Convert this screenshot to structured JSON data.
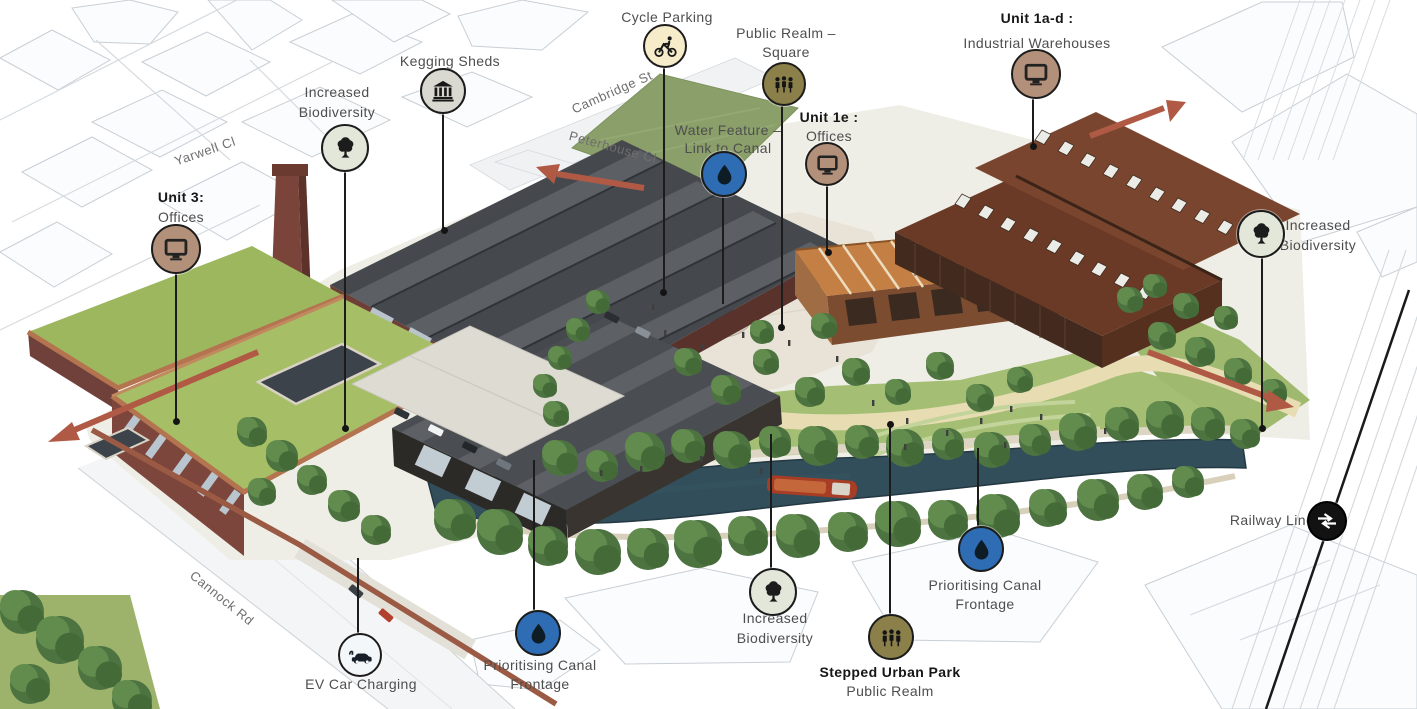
{
  "figure": {
    "kind": "annotated-masterplan-aerial-render"
  },
  "streets": [
    {
      "name": "Yarwell Cl"
    },
    {
      "name": "Cambridge St"
    },
    {
      "name": "Peterhouse Cl"
    },
    {
      "name": "Cannock Rd"
    }
  ],
  "callouts": [
    {
      "id": "unit-3",
      "lines": [
        "Unit 3:",
        "Offices"
      ],
      "icon": "computer-monitor"
    },
    {
      "id": "increased-biodiversity-top-left",
      "lines": [
        "Increased",
        "Biodiversity"
      ],
      "icon": "tree"
    },
    {
      "id": "kegging-sheds",
      "lines": [
        "Kegging Sheds"
      ],
      "icon": "heritage-building"
    },
    {
      "id": "cycle-parking",
      "lines": [
        "Cycle Parking"
      ],
      "icon": "bicycle"
    },
    {
      "id": "public-realm-square",
      "lines": [
        "Public Realm –",
        "Square"
      ],
      "icon": "people"
    },
    {
      "id": "water-feature",
      "lines": [
        "Water Feature –",
        "Link to Canal"
      ],
      "icon": "water-drop"
    },
    {
      "id": "unit-1e",
      "lines": [
        "Unit 1e :",
        "Offices"
      ],
      "icon": "computer-monitor"
    },
    {
      "id": "unit-1a-d",
      "lines": [
        "Unit 1a-d :",
        "Industrial Warehouses"
      ],
      "icon": "computer-monitor"
    },
    {
      "id": "increased-biodiversity-right",
      "lines": [
        "Increased",
        "Biodiversity"
      ],
      "icon": "tree"
    },
    {
      "id": "railway-line",
      "lines": [
        "Railway Line"
      ],
      "icon": "national-rail"
    },
    {
      "id": "prioritising-canal-frontage-right",
      "lines": [
        "Prioritising Canal",
        "Frontage"
      ],
      "icon": "water-drop"
    },
    {
      "id": "stepped-urban-park",
      "lines": [
        "Stepped Urban Park",
        "Public Realm"
      ],
      "icon": "people"
    },
    {
      "id": "increased-biodiversity-bottom",
      "lines": [
        "Increased",
        "Biodiversity"
      ],
      "icon": "tree"
    },
    {
      "id": "prioritising-canal-frontage-left",
      "lines": [
        "Prioritising Canal",
        "Frontage"
      ],
      "icon": "water-drop"
    },
    {
      "id": "ev-car-charging",
      "lines": [
        "EV Car Charging"
      ],
      "icon": "ev-car"
    }
  ],
  "badge_colors": {
    "offices": "#b3907a",
    "biodiversity": "#e2e7da",
    "heritage": "#d9d9d1",
    "cycle": "#f6ecca",
    "public_realm": "#8b8049",
    "water": "#2e6cb3",
    "rail": "#121212",
    "ev": "#f3f7fa"
  },
  "route_arrow_color": "#b05a45"
}
